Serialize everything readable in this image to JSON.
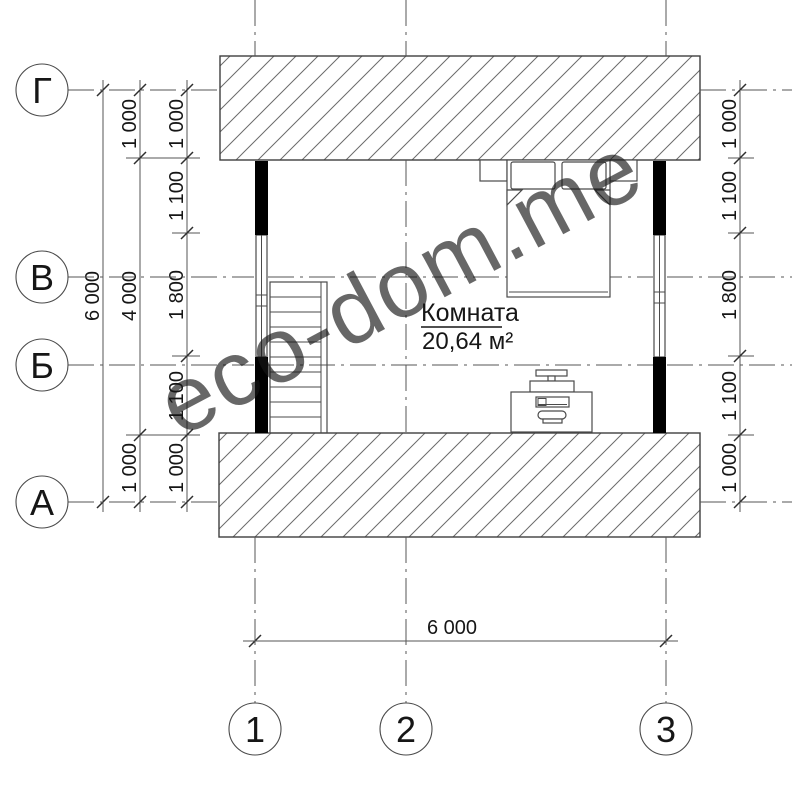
{
  "watermark": {
    "text": "eco-dom.me",
    "color": "#dce6ac"
  },
  "room": {
    "name": "Комната",
    "area": "20,64 м²"
  },
  "axes": {
    "rows": [
      {
        "label": "Г"
      },
      {
        "label": "В"
      },
      {
        "label": "Б"
      },
      {
        "label": "А"
      }
    ],
    "cols": [
      {
        "label": "1"
      },
      {
        "label": "2"
      },
      {
        "label": "3"
      }
    ]
  },
  "dimensions": {
    "left": {
      "total": "6 000",
      "inner": "4 000",
      "top_offset": "1 000",
      "bottom_offset": "1 000",
      "chain": [
        "1 000",
        "1 100",
        "1 800",
        "1 100",
        "1 000"
      ]
    },
    "right": {
      "chain": [
        "1 000",
        "1 100",
        "1 800",
        "1 100",
        "1 000"
      ]
    },
    "bottom": {
      "total": "6 000"
    }
  }
}
